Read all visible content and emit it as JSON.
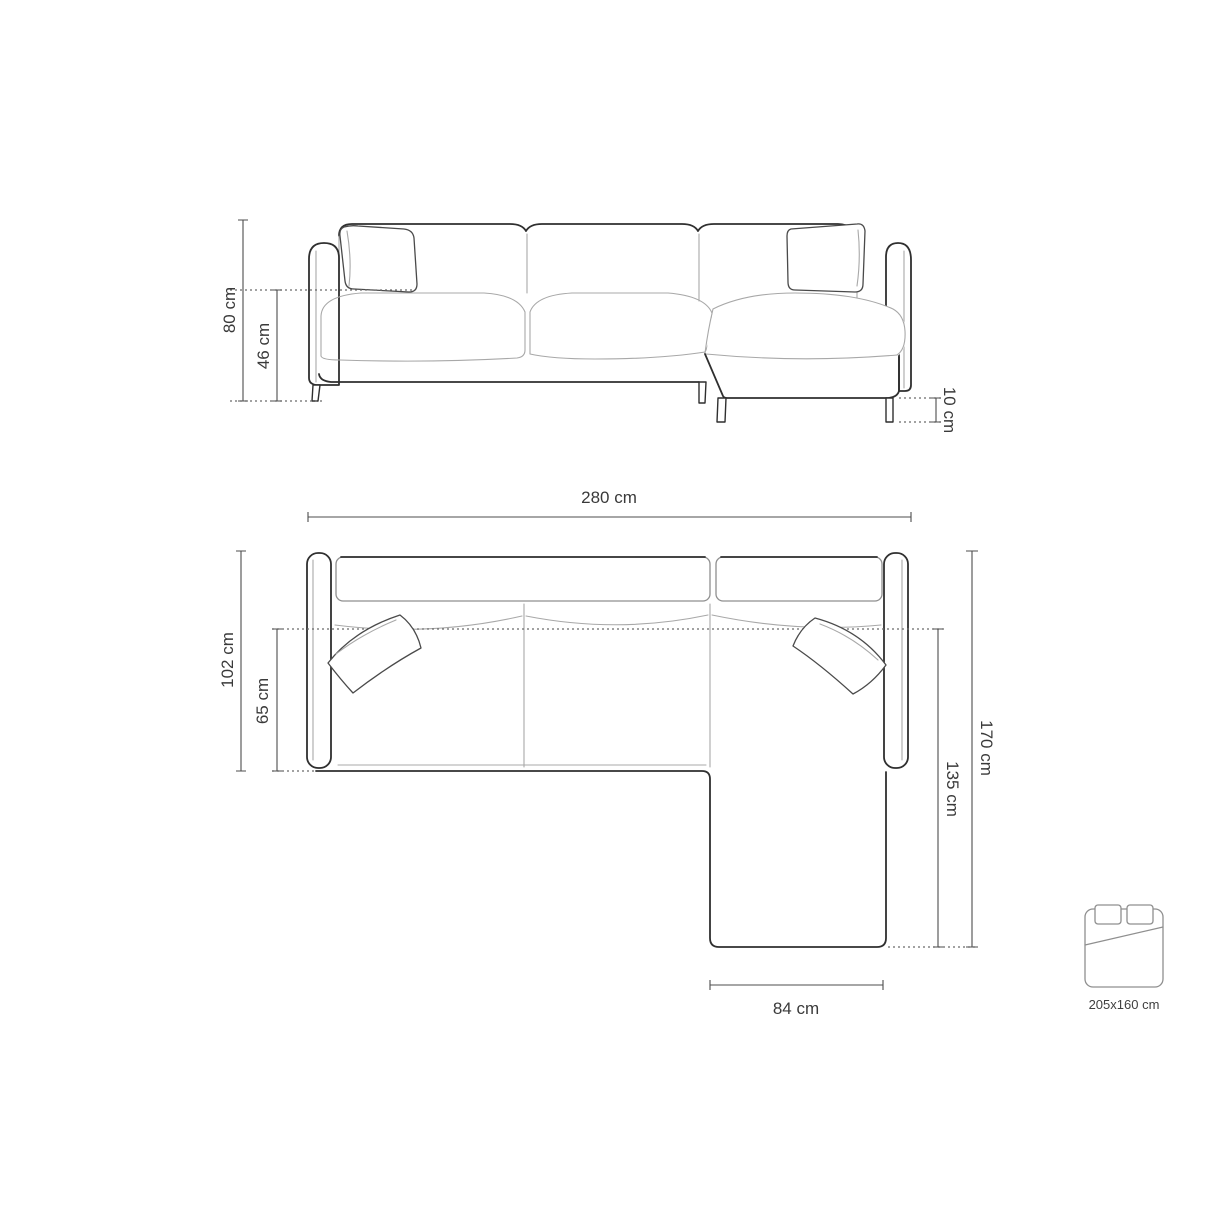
{
  "diagram": {
    "type": "corner-sofa-dimension-drawing",
    "front_view": {
      "dims": {
        "total_height": "80 cm",
        "seat_height": "46 cm",
        "leg_height": "10 cm"
      }
    },
    "top_view": {
      "dims": {
        "total_width": "280 cm",
        "total_depth": "102 cm",
        "seat_depth": "65 cm",
        "chaise_total_length": "170 cm",
        "chaise_extension_length": "135 cm",
        "chaise_width": "84 cm"
      }
    },
    "bed": {
      "icon": "double-bed-icon",
      "sleeping_area": "205x160 cm"
    },
    "colors": {
      "background": "#ffffff",
      "outline_dark": "#2f2f2f",
      "outline_light": "#a8a8a8",
      "dimension_line": "#4d4d4d",
      "dotted_line": "#6a6a6a",
      "label_text": "#3a3a3a",
      "bed_icon_line": "#8f8f8f"
    }
  }
}
